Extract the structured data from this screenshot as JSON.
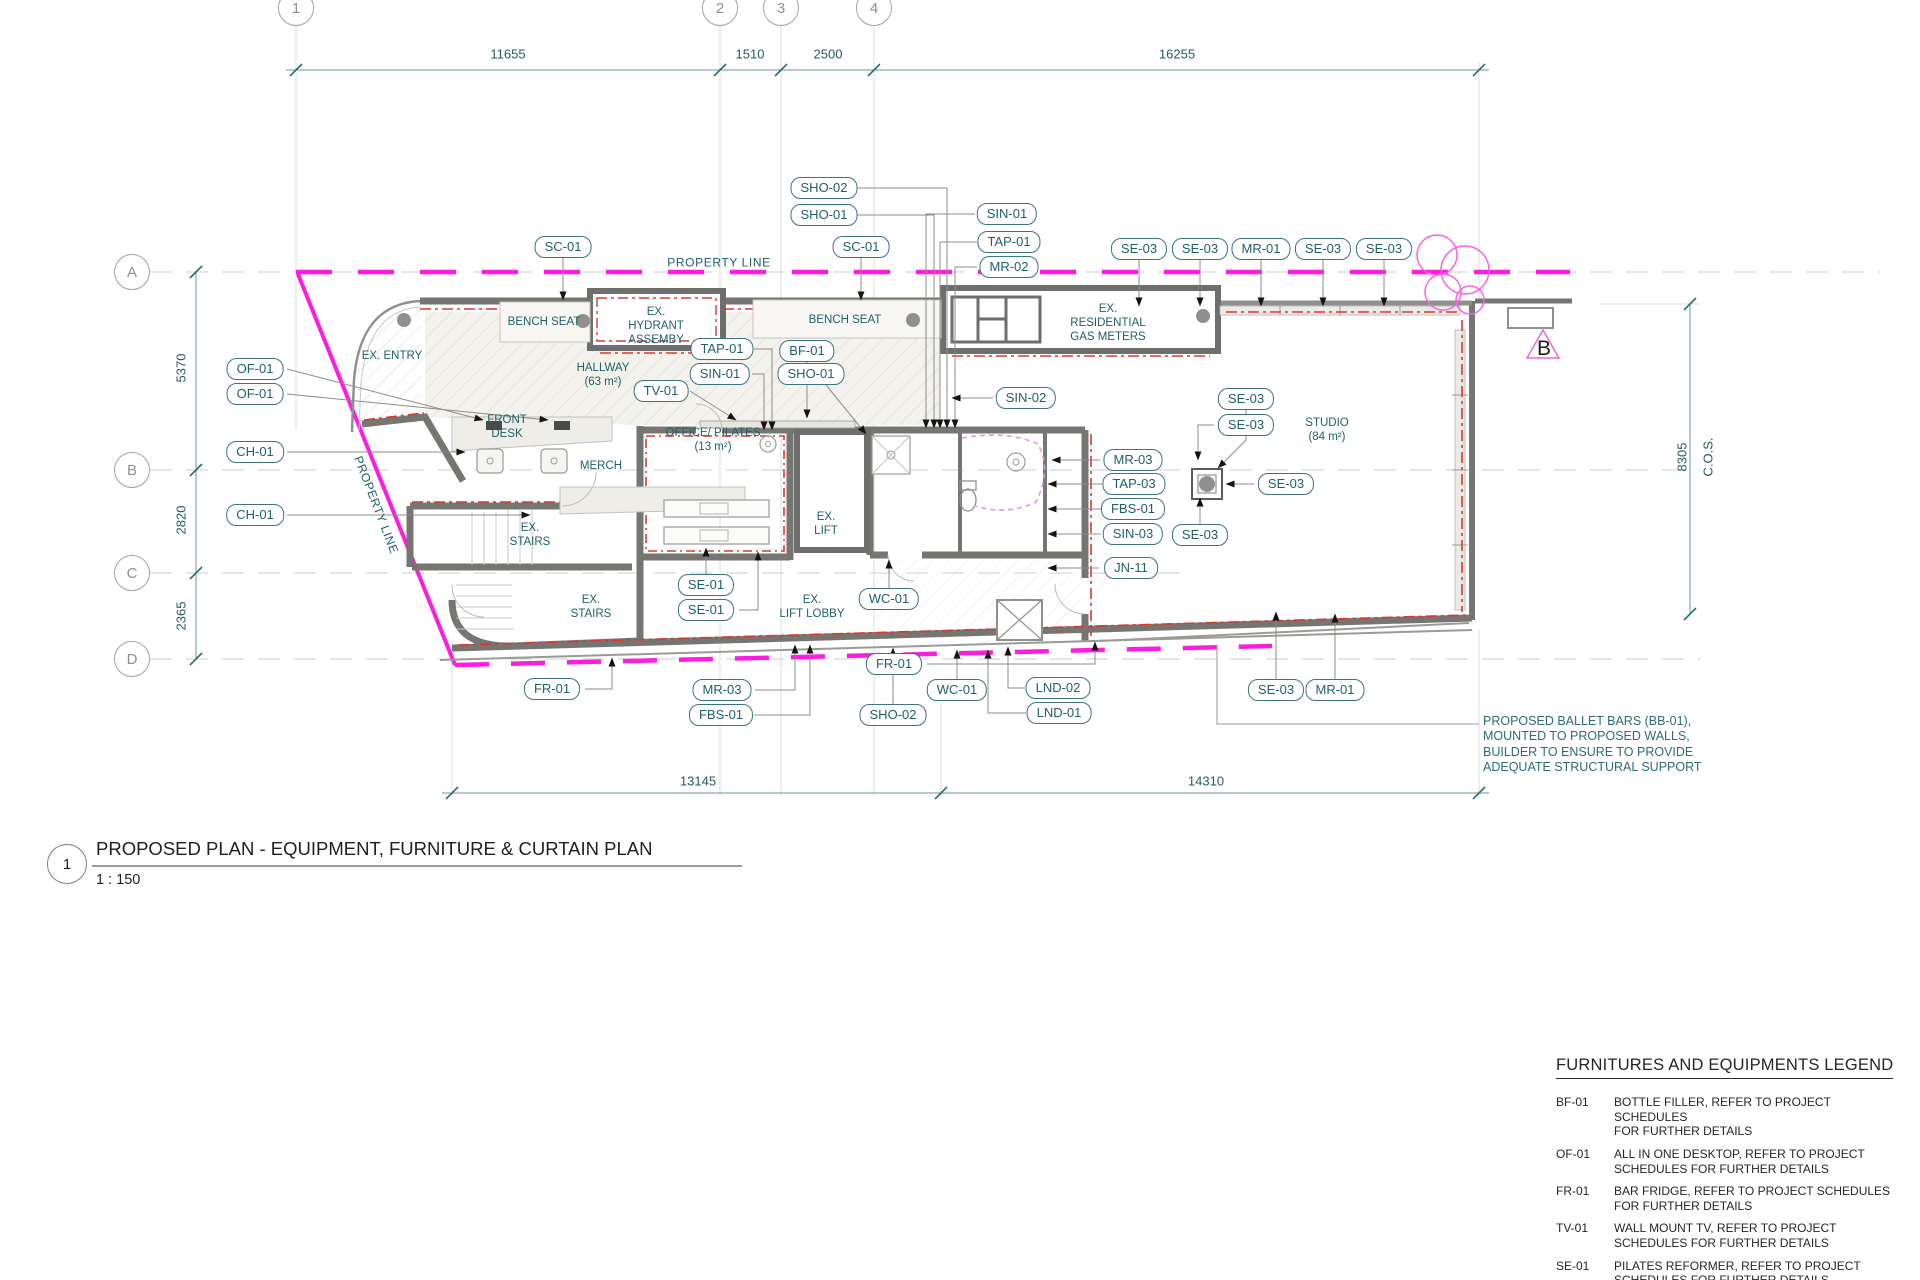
{
  "drawing": {
    "title_number": "1",
    "title": "PROPOSED PLAN - EQUIPMENT, FURNITURE & CURTAIN PLAN",
    "scale": "1 : 150"
  },
  "colors": {
    "tag_teal": "#1f5f66",
    "property_magenta": "#ff1ce0",
    "wall_gray": "#757572",
    "curtain_red": "#d63a2e",
    "dim_teal": "#235a61",
    "text_black": "#1f1f1f"
  },
  "grid": {
    "columns": [
      {
        "label": "1",
        "x": 296,
        "y": 8
      },
      {
        "label": "2",
        "x": 720,
        "y": 8
      },
      {
        "label": "3",
        "x": 781,
        "y": 8
      },
      {
        "label": "4",
        "x": 874,
        "y": 8
      }
    ],
    "rows": [
      {
        "label": "A",
        "x": 132,
        "y": 272
      },
      {
        "label": "B",
        "x": 132,
        "y": 470
      },
      {
        "label": "C",
        "x": 132,
        "y": 573
      },
      {
        "label": "D",
        "x": 132,
        "y": 659
      }
    ]
  },
  "dimensions": {
    "labels": [
      {
        "value": "11655",
        "x": 508,
        "y": 54
      },
      {
        "value": "1510",
        "x": 750,
        "y": 54
      },
      {
        "value": "2500",
        "x": 828,
        "y": 54
      },
      {
        "value": "16255",
        "x": 1177,
        "y": 54
      },
      {
        "value": "5370",
        "x": 181,
        "y": 368,
        "rot": true
      },
      {
        "value": "2820",
        "x": 181,
        "y": 520,
        "rot": true
      },
      {
        "value": "2365",
        "x": 181,
        "y": 616,
        "rot": true
      },
      {
        "value": "13145",
        "x": 698,
        "y": 781
      },
      {
        "value": "14310",
        "x": 1206,
        "y": 781
      },
      {
        "value": "8305",
        "x": 1682,
        "y": 457,
        "rot": true
      },
      {
        "value": "C.O.S.",
        "x": 1708,
        "y": 457,
        "rot": true
      }
    ]
  },
  "labels": [
    {
      "text": "PROPERTY LINE",
      "x": 719,
      "y": 263,
      "cls": "pl"
    },
    {
      "text": "PROPERTY LINE",
      "x": 376,
      "y": 505,
      "cls": "pl diag"
    },
    {
      "text": "EX. ENTRY",
      "x": 392,
      "y": 356
    },
    {
      "text": "BENCH SEAT",
      "x": 544,
      "y": 322
    },
    {
      "text": "BENCH SEAT",
      "x": 845,
      "y": 320
    },
    {
      "text": "EX.\nHYDRANT\nASSEMBY",
      "x": 656,
      "y": 326
    },
    {
      "text": "EX.\nRESIDENTIAL\nGAS METERS",
      "x": 1108,
      "y": 323
    },
    {
      "text": "HALLWAY\n(63 m²)",
      "x": 603,
      "y": 375
    },
    {
      "text": "FRONT\nDESK",
      "x": 507,
      "y": 427
    },
    {
      "text": "MERCH",
      "x": 601,
      "y": 466
    },
    {
      "text": "OFFICE/ PILATES\n(13 m²)",
      "x": 713,
      "y": 440
    },
    {
      "text": "STUDIO\n(84 m²)",
      "x": 1327,
      "y": 430
    },
    {
      "text": "EX.\nLIFT",
      "x": 826,
      "y": 524
    },
    {
      "text": "EX.\nLIFT LOBBY",
      "x": 812,
      "y": 607
    },
    {
      "text": "EX.\nSTAIRS",
      "x": 530,
      "y": 535
    },
    {
      "text": "EX.\nSTAIRS",
      "x": 591,
      "y": 607
    },
    {
      "text": "B",
      "x": 1544,
      "y": 349,
      "cls": "sect"
    }
  ],
  "tags": [
    {
      "label": "SC-01",
      "x": 563,
      "y": 247
    },
    {
      "label": "SC-01",
      "x": 861,
      "y": 247
    },
    {
      "label": "SHO-02",
      "x": 824,
      "y": 188
    },
    {
      "label": "SHO-01",
      "x": 824,
      "y": 215
    },
    {
      "label": "SIN-01",
      "x": 1007,
      "y": 214
    },
    {
      "label": "TAP-01",
      "x": 1009,
      "y": 242
    },
    {
      "label": "MR-02",
      "x": 1009,
      "y": 267
    },
    {
      "label": "SE-03",
      "x": 1139,
      "y": 249
    },
    {
      "label": "SE-03",
      "x": 1200,
      "y": 249
    },
    {
      "label": "MR-01",
      "x": 1261,
      "y": 249
    },
    {
      "label": "SE-03",
      "x": 1323,
      "y": 249
    },
    {
      "label": "SE-03",
      "x": 1384,
      "y": 249
    },
    {
      "label": "OF-01",
      "x": 255,
      "y": 369
    },
    {
      "label": "OF-01",
      "x": 255,
      "y": 394
    },
    {
      "label": "CH-01",
      "x": 255,
      "y": 452
    },
    {
      "label": "CH-01",
      "x": 255,
      "y": 515
    },
    {
      "label": "TAP-01",
      "x": 722,
      "y": 349
    },
    {
      "label": "SIN-01",
      "x": 720,
      "y": 374
    },
    {
      "label": "TV-01",
      "x": 661,
      "y": 391
    },
    {
      "label": "BF-01",
      "x": 807,
      "y": 351
    },
    {
      "label": "SHO-01",
      "x": 811,
      "y": 374
    },
    {
      "label": "SIN-02",
      "x": 1026,
      "y": 398
    },
    {
      "label": "SE-03",
      "x": 1246,
      "y": 399
    },
    {
      "label": "SE-03",
      "x": 1246,
      "y": 425
    },
    {
      "label": "MR-03",
      "x": 1133,
      "y": 460
    },
    {
      "label": "TAP-03",
      "x": 1134,
      "y": 484
    },
    {
      "label": "FBS-01",
      "x": 1133,
      "y": 509
    },
    {
      "label": "SIN-03",
      "x": 1133,
      "y": 534
    },
    {
      "label": "JN-11",
      "x": 1131,
      "y": 568
    },
    {
      "label": "SE-03",
      "x": 1286,
      "y": 484
    },
    {
      "label": "SE-03",
      "x": 1200,
      "y": 535
    },
    {
      "label": "SE-01",
      "x": 706,
      "y": 585
    },
    {
      "label": "SE-01",
      "x": 706,
      "y": 610
    },
    {
      "label": "WC-01",
      "x": 889,
      "y": 599
    },
    {
      "label": "FR-01",
      "x": 894,
      "y": 664
    },
    {
      "label": "FR-01",
      "x": 552,
      "y": 689
    },
    {
      "label": "MR-03",
      "x": 722,
      "y": 690
    },
    {
      "label": "FBS-01",
      "x": 721,
      "y": 715
    },
    {
      "label": "SHO-02",
      "x": 893,
      "y": 715
    },
    {
      "label": "WC-01",
      "x": 957,
      "y": 690
    },
    {
      "label": "LND-02",
      "x": 1058,
      "y": 688
    },
    {
      "label": "LND-01",
      "x": 1059,
      "y": 713
    },
    {
      "label": "SE-03",
      "x": 1276,
      "y": 690
    },
    {
      "label": "MR-01",
      "x": 1335,
      "y": 690
    }
  ],
  "note": {
    "text": "PROPOSED BALLET BARS (BB-01),\nMOUNTED TO PROPOSED WALLS,\nBUILDER TO ENSURE TO PROVIDE\nADEQUATE STRUCTURAL SUPPORT"
  },
  "legend": {
    "heading": "FURNITURES AND EQUIPMENTS LEGEND",
    "items": [
      {
        "code": "BF-01",
        "desc": "BOTTLE FILLER, REFER TO PROJECT SCHEDULES\nFOR FURTHER DETAILS"
      },
      {
        "code": "OF-01",
        "desc": "ALL IN ONE DESKTOP, REFER TO PROJECT\nSCHEDULES FOR FURTHER DETAILS"
      },
      {
        "code": "FR-01",
        "desc": "BAR FRIDGE, REFER TO PROJECT SCHEDULES\nFOR FURTHER DETAILS"
      },
      {
        "code": "TV-01",
        "desc": "WALL MOUNT TV, REFER TO PROJECT\nSCHEDULES FOR FURTHER DETAILS"
      },
      {
        "code": "SE-01",
        "desc": "PILATES REFORMER, REFER TO PROJECT\nSCHEDULES FOR FURTHER DETAILS"
      },
      {
        "code": "SE-03",
        "desc": "WALL MOUNTED BALLET BARRE, REFER TO\nPROJECT SCHEDULES FOR FURTHER DETAILS"
      }
    ]
  }
}
